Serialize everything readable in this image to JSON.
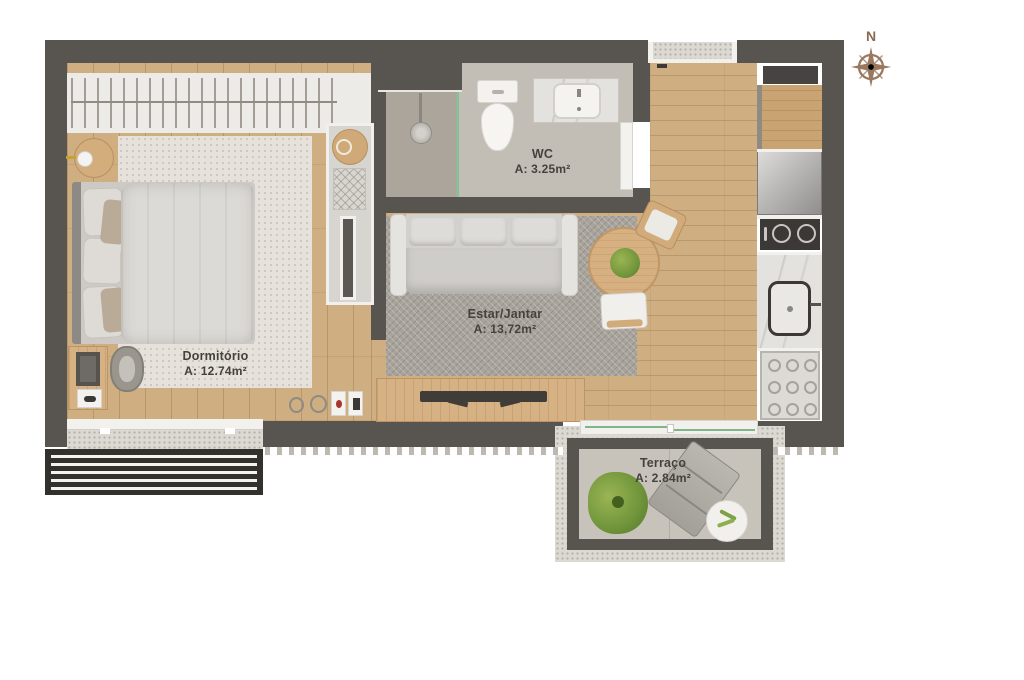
{
  "image_type": "apartment floor plan, top-down rendered view",
  "compass": {
    "label": "N"
  },
  "rooms": [
    {
      "name": "Dormitório",
      "area": "A: 12.74m²"
    },
    {
      "name": "Estar/Jantar",
      "area": "A: 13,72m²"
    },
    {
      "name": "WC",
      "area": "A: 3.25m²"
    },
    {
      "name": "Terraço",
      "area": "A: 2.84m²"
    }
  ],
  "furniture": {
    "dormitorio": [
      "wardrobe with hangers",
      "double bed",
      "round side table with lamp",
      "desk with laptop",
      "stool",
      "light rug",
      "shelf unit with basket and mirror"
    ],
    "estar_jantar": [
      "three-seat sofa",
      "herringbone rug",
      "round dining table with plant",
      "dining chair top",
      "dining chair bottom",
      "tv console with tv"
    ],
    "wc": [
      "shower head",
      "glass partition",
      "toilet",
      "sink counter",
      "door leaf"
    ],
    "kitchen": [
      "wood counter",
      "fridge",
      "two-burner cooktop",
      "counter sink",
      "dish rack"
    ],
    "terraco": [
      "sliding glass door",
      "large plant",
      "lounge chair",
      "small round table"
    ],
    "exterior": [
      "louver grille",
      "entry opening",
      "speckled ledge",
      "sawtooth trim"
    ]
  },
  "colors": {
    "wall": "#585450",
    "wood_floor": "#cfae82",
    "furniture_wood": "#d2ab7a",
    "rug_light": "#e6e2db",
    "rug_herringbone": "#a8a39b",
    "glass": "#8cbd94",
    "plant": "#6f943a",
    "compass": "#9a7860",
    "label_text": "#45413d",
    "background": "#ffffff"
  }
}
